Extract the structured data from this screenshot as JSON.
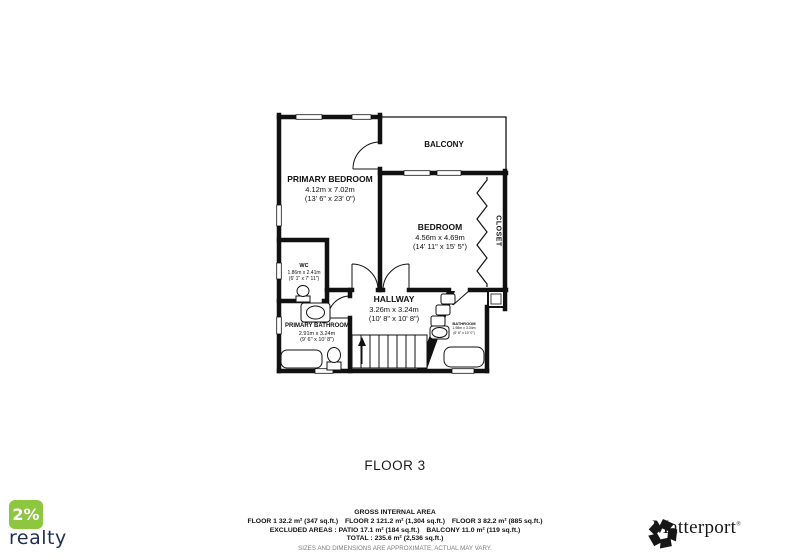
{
  "plan": {
    "floor_label": "FLOOR 3",
    "rooms": {
      "primary_bedroom": {
        "name": "PRIMARY BEDROOM",
        "metric": "4.12m x 7.02m",
        "imperial": "(13' 6\" x 23' 0\")"
      },
      "balcony": {
        "name": "BALCONY"
      },
      "bedroom": {
        "name": "BEDROOM",
        "metric": "4.56m x 4.69m",
        "imperial": "(14' 11\" x 15' 5\")"
      },
      "closet": {
        "name": "CLOSET"
      },
      "wc": {
        "name": "WC",
        "metric": "1.86m x 2.41m",
        "imperial": "(6' 1\" x 7' 11\")"
      },
      "hallway": {
        "name": "HALLWAY",
        "metric": "3.26m x 3.24m",
        "imperial": "(10' 8\" x 10' 8\")"
      },
      "primary_bathroom": {
        "name": "PRIMARY BATHROOM",
        "metric": "2.91m x 3.24m",
        "imperial": "(9' 6\" x 10' 8\")"
      },
      "bathroom": {
        "name": "BATHROOM",
        "metric": "1.98m x 3.04m",
        "imperial": "(6' 6\" x 10' 0\")"
      }
    }
  },
  "footer": {
    "title": "GROSS INTERNAL AREA",
    "line_floors": "FLOOR 1 32.2 m² (347 sq.ft.) FLOOR 2 121.2 m² (1,304 sq.ft.) FLOOR 3 82.2 m² (885 sq.ft.)",
    "line_excluded": "EXCLUDED AREAS :  PATIO 17.1 m² (184 sq.ft.) BALCONY 11.0 m² (119 sq.ft.)",
    "line_total": "TOTAL :  235.6 m² (2,536 sq.ft.)",
    "disclaimer": "SIZES AND DIMENSIONS ARE APPROXIMATE, ACTUAL MAY VARY."
  },
  "branding": {
    "realty": {
      "badge": "2%",
      "name": "realty",
      "green": "#8DC63F",
      "navy": "#1E2F4F"
    },
    "matterport": {
      "name": "Matterport",
      "mark": "®",
      "black": "#161616"
    }
  }
}
